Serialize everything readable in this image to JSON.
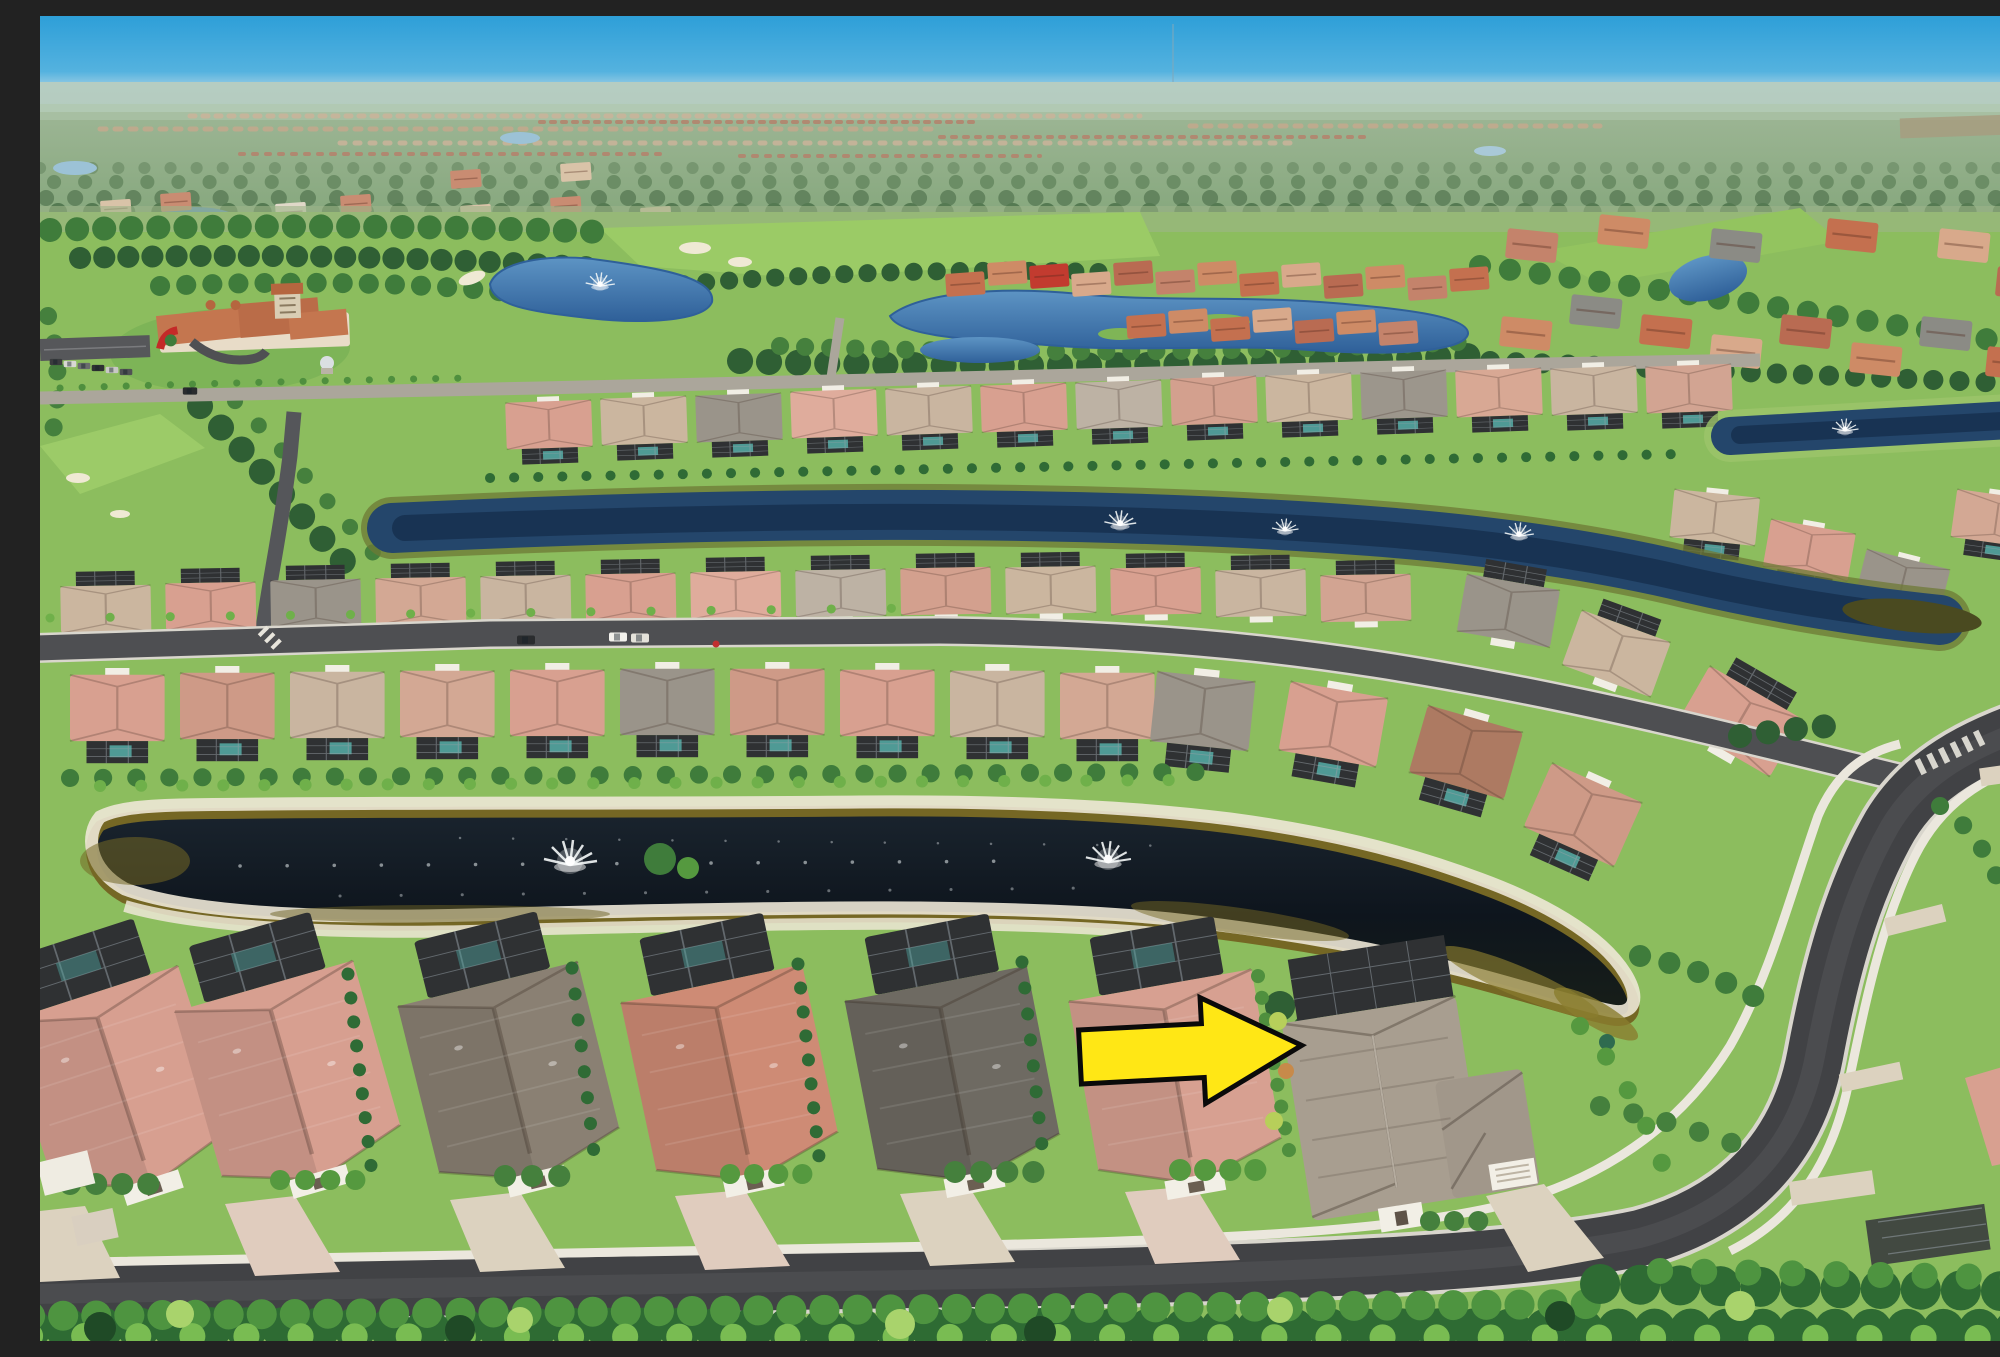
{
  "meta": {
    "type": "aerial-drone-photo",
    "subject": "aerial view of a Florida-style golf community: rows of tile-roof single-family homes, dark pond with fountains, canals, curving streets, golf course and clubhouse in the distance, bright yellow arrow marking one home",
    "width": 2000,
    "height": 1325
  },
  "palette": {
    "sky_top": "#2E9FD8",
    "sky_horizon": "#A9D3E4",
    "distant_land": "#93AC8A",
    "grass": "#8CBD5E",
    "fairway": "#9BCB66",
    "lake_blue": "#3E78B2",
    "canal_blue": "#24466B",
    "pond_dark": "#10181F",
    "pond_amber": "#756724",
    "sand": "#EDE7D6",
    "roof_salmon": "#D8A090",
    "roof_red": "#CE8B75",
    "roof_gray": "#8A8073",
    "roof_dark": "#6E6A62",
    "target_roof": "#A89E90",
    "asphalt": "#414245",
    "sidewalk": "#E9E5DB",
    "paver": "#DCD2BF",
    "clubhouse_roof": "#C4764F",
    "red_accent": "#C42A28"
  },
  "annotation": {
    "shape": "arrow-right",
    "points": "0,-27 123,-27 123,-53 222,0 123,53 123,27 0,27",
    "transform": "translate(1040,1041) rotate(-3)",
    "fill": "#FFE715",
    "stroke": "#0A0A0A",
    "strokeWidth": "5"
  },
  "fountains": [
    {
      "x": 560,
      "y": 268,
      "s": 0.55
    },
    {
      "x": 1805,
      "y": 413,
      "s": 0.5
    },
    {
      "x": 1080,
      "y": 507,
      "s": 0.6
    },
    {
      "x": 1245,
      "y": 513,
      "s": 0.5
    },
    {
      "x": 1479,
      "y": 518,
      "s": 0.55
    },
    {
      "x": 530,
      "y": 845,
      "s": 1
    },
    {
      "x": 1068,
      "y": 843,
      "s": 0.85
    }
  ],
  "houses": {
    "upper_row": [
      {
        "x": 465,
        "y": 382,
        "c": "#D8A090"
      },
      {
        "x": 560,
        "y": 378,
        "c": "#CBB69F"
      },
      {
        "x": 655,
        "y": 375,
        "c": "#9A948A"
      },
      {
        "x": 750,
        "y": 371,
        "c": "#DFAC9C"
      },
      {
        "x": 845,
        "y": 368,
        "c": "#C9B5A0"
      },
      {
        "x": 940,
        "y": 365,
        "c": "#D8A090"
      },
      {
        "x": 1035,
        "y": 362,
        "c": "#BDB2A4"
      },
      {
        "x": 1130,
        "y": 358,
        "c": "#D3A08E"
      },
      {
        "x": 1225,
        "y": 355,
        "c": "#CBB69F"
      },
      {
        "x": 1320,
        "y": 352,
        "c": "#9C968C"
      },
      {
        "x": 1415,
        "y": 350,
        "c": "#D8A894"
      },
      {
        "x": 1510,
        "y": 348,
        "c": "#C9B5A0"
      },
      {
        "x": 1605,
        "y": 346,
        "c": "#D2A492"
      }
    ],
    "upper_row_curve": [
      {
        "x": 1635,
        "y": 468,
        "r": 6,
        "c": "#CBB69F"
      },
      {
        "x": 1732,
        "y": 498,
        "r": 10,
        "c": "#D8A090"
      },
      {
        "x": 1828,
        "y": 528,
        "r": 14,
        "c": "#9A948A"
      },
      {
        "x": 1918,
        "y": 468,
        "r": 8,
        "c": "#D3A894"
      }
    ],
    "mid_row": [
      {
        "x": 20,
        "y": 556,
        "c": "#CBB69F"
      },
      {
        "x": 125,
        "y": 553,
        "c": "#D8A090"
      },
      {
        "x": 230,
        "y": 550,
        "c": "#9A948A"
      },
      {
        "x": 335,
        "y": 548,
        "c": "#D3A894"
      },
      {
        "x": 440,
        "y": 546,
        "c": "#C9B5A0"
      },
      {
        "x": 545,
        "y": 544,
        "c": "#D8A090"
      },
      {
        "x": 650,
        "y": 542,
        "c": "#DFAC9C"
      },
      {
        "x": 755,
        "y": 540,
        "c": "#BDB2A4"
      },
      {
        "x": 860,
        "y": 538,
        "c": "#D3A08E"
      },
      {
        "x": 965,
        "y": 537,
        "c": "#CBB69F"
      },
      {
        "x": 1070,
        "y": 538,
        "c": "#D8A090"
      },
      {
        "x": 1175,
        "y": 540,
        "c": "#C9B5A0"
      },
      {
        "x": 1280,
        "y": 545,
        "c": "#D2A492"
      }
    ],
    "mid_row_curve": [
      {
        "x": 1430,
        "y": 540,
        "r": 10,
        "c": "#9A948A",
        "sx": 1.1,
        "sy": 0.75
      },
      {
        "x": 1548,
        "y": 577,
        "r": 20,
        "c": "#CBB69F",
        "sx": 1.1,
        "sy": 0.75
      },
      {
        "x": 1680,
        "y": 632,
        "r": 30,
        "c": "#D8A090",
        "sx": 1.25,
        "sy": 0.85
      }
    ],
    "lake_row": [
      {
        "x": 30,
        "y": 652,
        "c": "#D8A090"
      },
      {
        "x": 140,
        "y": 650,
        "c": "#CE9A87"
      },
      {
        "x": 250,
        "y": 649,
        "c": "#C9B5A0"
      },
      {
        "x": 360,
        "y": 648,
        "c": "#D3A894"
      },
      {
        "x": 470,
        "y": 647,
        "c": "#D8A090"
      },
      {
        "x": 580,
        "y": 646,
        "c": "#9A948A"
      },
      {
        "x": 690,
        "y": 646,
        "c": "#CE9A87"
      },
      {
        "x": 800,
        "y": 647,
        "c": "#D8A090"
      },
      {
        "x": 910,
        "y": 648,
        "c": "#C9B5A0"
      },
      {
        "x": 1020,
        "y": 650,
        "c": "#D3A894"
      }
    ],
    "lake_row_curve": [
      {
        "x": 1118,
        "y": 648,
        "r": 6,
        "c": "#9A948A"
      },
      {
        "x": 1252,
        "y": 658,
        "r": 10,
        "c": "#D8A090"
      },
      {
        "x": 1390,
        "y": 682,
        "r": 16,
        "c": "#AD7A62"
      },
      {
        "x": 1515,
        "y": 740,
        "r": 24,
        "c": "#CE9A87"
      }
    ],
    "foreground_row": [
      {
        "x": -60,
        "y": 952,
        "r": -18,
        "c": "#D79F90"
      },
      {
        "x": 115,
        "y": 940,
        "r": -16,
        "c": "#D79F90"
      },
      {
        "x": 340,
        "y": 934,
        "r": -14,
        "c": "#8A8073"
      },
      {
        "x": 565,
        "y": 930,
        "r": -12,
        "c": "#CE8B75"
      },
      {
        "x": 790,
        "y": 928,
        "r": -11,
        "c": "#6E6A62"
      },
      {
        "x": 1015,
        "y": 928,
        "r": -10,
        "c": "#D7A091"
      }
    ]
  },
  "villas": [
    {
      "x": 905,
      "y": 258,
      "c": "#C4704F"
    },
    {
      "x": 947,
      "y": 247,
      "c": "#CE8B66"
    },
    {
      "x": 989,
      "y": 250,
      "c": "#C23B2F"
    },
    {
      "x": 1031,
      "y": 258,
      "c": "#D8A98B"
    },
    {
      "x": 1073,
      "y": 247,
      "c": "#B96B52"
    },
    {
      "x": 1115,
      "y": 256,
      "c": "#C4836B"
    },
    {
      "x": 1157,
      "y": 247,
      "c": "#CE8B66"
    },
    {
      "x": 1199,
      "y": 258,
      "c": "#C4704F"
    },
    {
      "x": 1241,
      "y": 249,
      "c": "#D8A98B"
    },
    {
      "x": 1283,
      "y": 260,
      "c": "#B96B52"
    },
    {
      "x": 1325,
      "y": 251,
      "c": "#CE8B66"
    },
    {
      "x": 1367,
      "y": 262,
      "c": "#C4836B"
    },
    {
      "x": 1409,
      "y": 253,
      "c": "#C4704F"
    },
    {
      "x": 1128,
      "y": 295,
      "c": "#CE8B66"
    },
    {
      "x": 1170,
      "y": 303,
      "c": "#C4704F"
    },
    {
      "x": 1212,
      "y": 294,
      "c": "#D8A98B"
    },
    {
      "x": 1254,
      "y": 305,
      "c": "#B96B52"
    },
    {
      "x": 1296,
      "y": 296,
      "c": "#CE8B66"
    },
    {
      "x": 1338,
      "y": 307,
      "c": "#C4836B"
    },
    {
      "x": 1086,
      "y": 300,
      "c": "#C4704F"
    }
  ],
  "right_villas": [
    {
      "x": 1462,
      "y": 300,
      "c": "#CE8B66"
    },
    {
      "x": 1532,
      "y": 278,
      "c": "#8B8B85"
    },
    {
      "x": 1602,
      "y": 298,
      "c": "#C4704F"
    },
    {
      "x": 1672,
      "y": 318,
      "c": "#D8A98B"
    },
    {
      "x": 1742,
      "y": 298,
      "c": "#B96B52"
    },
    {
      "x": 1812,
      "y": 326,
      "c": "#CE8B66"
    },
    {
      "x": 1882,
      "y": 300,
      "c": "#8B8B85"
    },
    {
      "x": 1948,
      "y": 330,
      "c": "#C4704F"
    },
    {
      "x": 1468,
      "y": 212,
      "c": "#C4836B"
    },
    {
      "x": 1560,
      "y": 198,
      "c": "#CE8B66"
    },
    {
      "x": 1672,
      "y": 212,
      "c": "#8B8B85"
    },
    {
      "x": 1788,
      "y": 202,
      "c": "#C4704F"
    },
    {
      "x": 1900,
      "y": 212,
      "c": "#D8A98B"
    },
    {
      "x": 1958,
      "y": 250,
      "c": "#B96B52"
    }
  ],
  "far_villas": [
    {
      "x": 60,
      "y": 185,
      "c": "#D9C3A8"
    },
    {
      "x": 120,
      "y": 178,
      "c": "#C98C72"
    },
    {
      "x": 235,
      "y": 188,
      "c": "#E0D8C8"
    },
    {
      "x": 300,
      "y": 180,
      "c": "#C98C72"
    },
    {
      "x": 58,
      "y": 226,
      "c": "#D9C3A8"
    },
    {
      "x": 250,
      "y": 230,
      "c": "#C98C72"
    },
    {
      "x": 322,
      "y": 242,
      "c": "#D9C3A8"
    },
    {
      "x": 28,
      "y": 252,
      "c": "#E0D8C8"
    },
    {
      "x": 120,
      "y": 256,
      "c": "#C98C72"
    },
    {
      "x": 420,
      "y": 190,
      "c": "#D9C3A8"
    },
    {
      "x": 510,
      "y": 182,
      "c": "#C98C72"
    },
    {
      "x": 600,
      "y": 192,
      "c": "#D9C3A8"
    },
    {
      "x": 410,
      "y": 155,
      "c": "#C98C72"
    },
    {
      "x": 520,
      "y": 148,
      "c": "#D9C3A8"
    }
  ],
  "vehicles": {
    "street": [
      {
        "x": 486,
        "y": 624,
        "c": "#2A2C2E"
      },
      {
        "x": 578,
        "y": 621,
        "c": "#F2F1EC"
      },
      {
        "x": 600,
        "y": 622,
        "c": "#E4E2DA"
      }
    ],
    "parking": [
      {
        "x": 16,
        "y": 346,
        "c": "#3A3C3E",
        "s": 0.7
      },
      {
        "x": 30,
        "y": 348,
        "c": "#D8D8D4",
        "s": 0.7
      },
      {
        "x": 44,
        "y": 350,
        "c": "#6A6C6E",
        "s": 0.7
      },
      {
        "x": 58,
        "y": 352,
        "c": "#2E3032",
        "s": 0.7
      },
      {
        "x": 72,
        "y": 354,
        "c": "#C8C8C4",
        "s": 0.7
      },
      {
        "x": 86,
        "y": 356,
        "c": "#505254",
        "s": 0.7
      },
      {
        "x": 150,
        "y": 375,
        "c": "#2A2C2E",
        "s": 0.8
      }
    ],
    "pedestrian": {
      "x": 676,
      "y": 628,
      "c": "#C03030"
    }
  }
}
